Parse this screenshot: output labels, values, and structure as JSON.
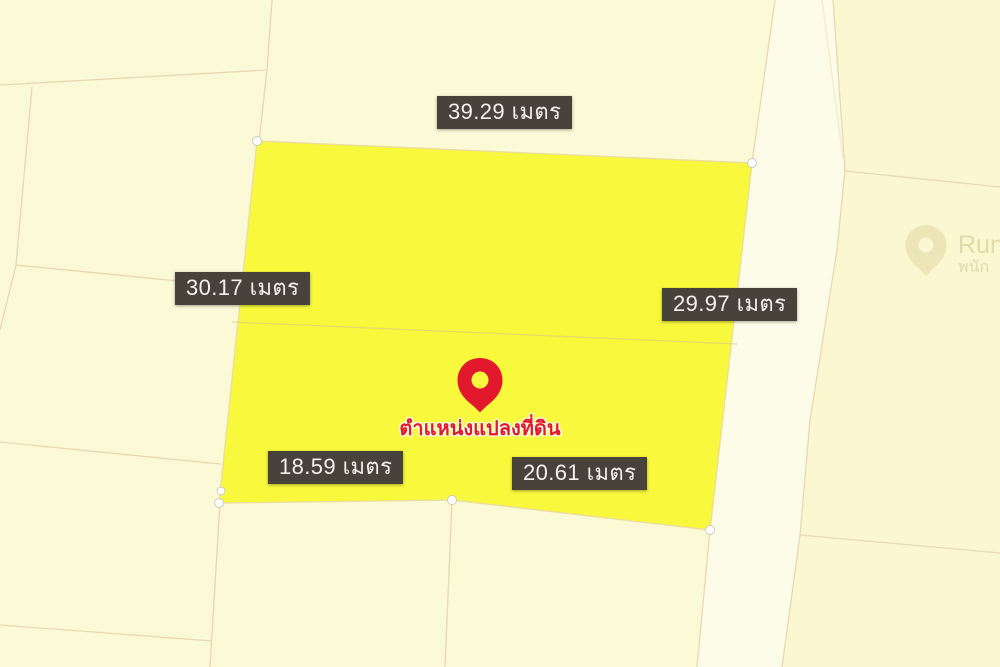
{
  "map": {
    "colors": {
      "background": "#fbf9d6",
      "road_corridor_fill": "#fdfce9",
      "east_parcel_fill": "#fbf7d0",
      "parcel_line": "#ead6b0",
      "plot_fill": "#f8f83c",
      "plot_edge": "#ecdf9b",
      "badge_background": "#47433a",
      "badge_text": "#f3f1ec",
      "pin_red": "#e2182d",
      "vertex_marker": "#ffffff",
      "watermark": "#cdc38a"
    },
    "unit": "เมตร",
    "measurements": [
      {
        "id": "top",
        "value": "39.29",
        "unit": "เมตร",
        "label": "39.29 เมตร"
      },
      {
        "id": "left",
        "value": "30.17",
        "unit": "เมตร",
        "label": "30.17 เมตร"
      },
      {
        "id": "right",
        "value": "29.97",
        "unit": "เมตร",
        "label": "29.97 เมตร"
      },
      {
        "id": "bottom-left",
        "value": "18.59",
        "unit": "เมตร",
        "label": "18.59 เมตร"
      },
      {
        "id": "bottom-right",
        "value": "20.61",
        "unit": "เมตร",
        "label": "20.61 เมตร"
      }
    ],
    "pin_label": "ตำแหน่งแปลงที่ดิน",
    "watermark": {
      "line1": "Run",
      "line2": "พนัก"
    }
  }
}
